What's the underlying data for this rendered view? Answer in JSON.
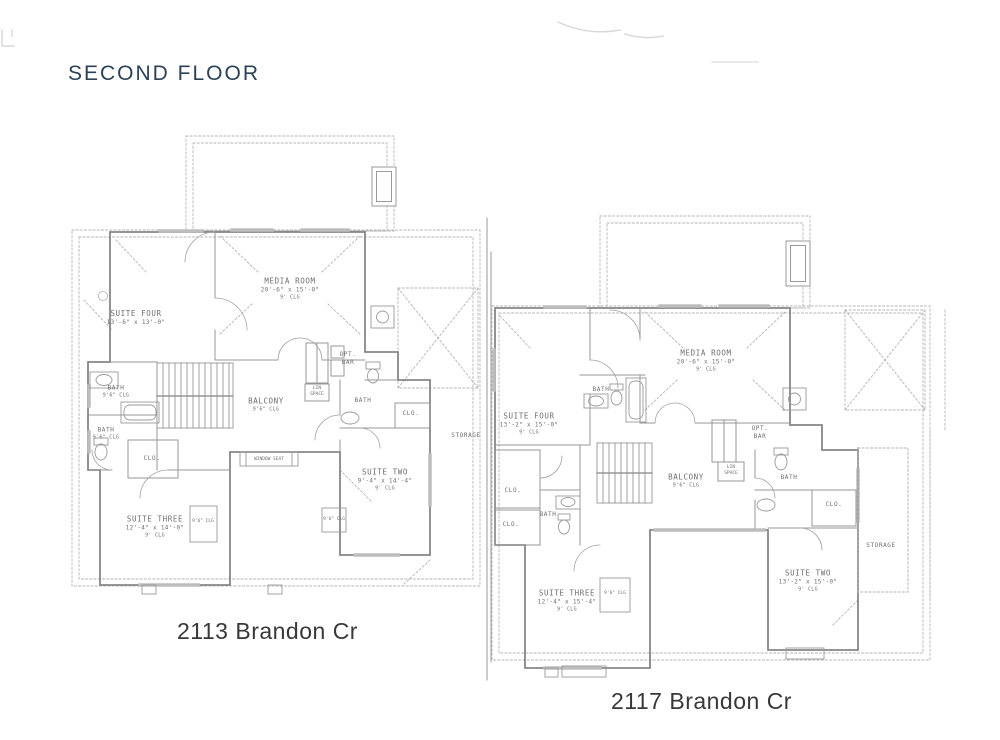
{
  "title": "SECOND FLOOR",
  "accent_color": "#2b4257",
  "line_color": "#8c8c8c",
  "plans": [
    {
      "address": "2113 Brandon Cr",
      "labels": {
        "suite_four": {
          "name": "SUITE FOUR",
          "dims": "13'-6\" x 13'-0\""
        },
        "media_room": {
          "name": "MEDIA ROOM",
          "dims": "20'-6\" x 15'-0\"",
          "clg": "9' CLG"
        },
        "bath_a": {
          "name": "BATH",
          "clg": "9'6\" CLG"
        },
        "bath_b": {
          "name": "BATH",
          "clg": "9'6\" CLG"
        },
        "clo_a": {
          "name": "CLO."
        },
        "suite_three": {
          "name": "SUITE THREE",
          "dims": "12'-4\" x 14'-0\"",
          "clg": "9' CLG"
        },
        "balcony": {
          "name": "BALCONY",
          "clg": "9'6\" CLG"
        },
        "opt_bar": {
          "name": "OPT.",
          "sub": "BAR"
        },
        "lin_space": {
          "name": "LIN",
          "sub": "SPACE"
        },
        "bath_c": {
          "name": "BATH"
        },
        "clo_b": {
          "name": "CLO."
        },
        "storage": {
          "name": "STORAGE"
        },
        "suite_two": {
          "name": "SUITE TWO",
          "dims": "9'-4\" x 14'-4\"",
          "clg": "9' CLG"
        },
        "window_seat": {
          "name": "WINDOW SEAT"
        },
        "bay_clg_a": {
          "name": "9'6\" CLG"
        },
        "bay_clg_b": {
          "name": "9'6\" CLG"
        }
      }
    },
    {
      "address": "2117 Brandon Cr",
      "labels": {
        "suite_four": {
          "name": "SUITE FOUR",
          "dims": "13'-2\" x 15'-0\"",
          "clg": "9' CLG"
        },
        "media_room": {
          "name": "MEDIA ROOM",
          "dims": "20'-6\" x 15'-0\"",
          "clg": "9' CLG"
        },
        "bath_a": {
          "name": "BATH"
        },
        "balcony": {
          "name": "BALCONY",
          "clg": "9'6\" CLG"
        },
        "opt_bar": {
          "name": "OPT.",
          "sub": "BAR"
        },
        "lin_space": {
          "name": "LIN",
          "sub": "SPACE"
        },
        "bath_b": {
          "name": "BATH"
        },
        "clo_a": {
          "name": "CLO."
        },
        "clo_b": {
          "name": "CLO."
        },
        "clo_c": {
          "name": "CLO."
        },
        "bath_c": {
          "name": "BATH"
        },
        "suite_three": {
          "name": "SUITE THREE",
          "dims": "12'-4\" x 15'-4\"",
          "clg": "9' CLG"
        },
        "suite_two": {
          "name": "SUITE TWO",
          "dims": "13'-2\" x 15'-0\"",
          "clg": "9' CLG"
        },
        "storage": {
          "name": "STORAGE"
        },
        "bay_clg_a": {
          "name": "9'6\" CLG"
        }
      }
    }
  ]
}
